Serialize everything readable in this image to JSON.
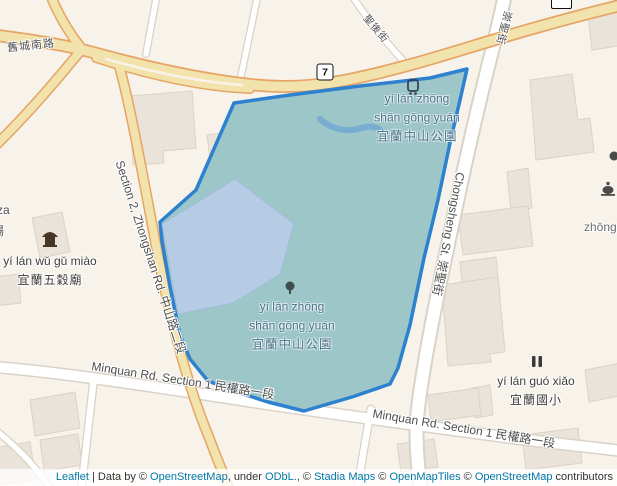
{
  "window": {
    "width": 617,
    "height": 486
  },
  "colors": {
    "land": "#f8f3ea",
    "building": "#eae3d9",
    "building_outline": "#dcd2c5",
    "major_road_fill": "#f2e2ab",
    "major_road_casing": "#e5a566",
    "minor_road_fill": "#ffffff",
    "minor_road_casing": "#d9d2c7",
    "park_overlay_fill": "#9dc6c9",
    "park_overlay_stroke": "#2d81cf",
    "inner_ground_fill": "#b5cce4",
    "water": "#78acd1",
    "road_label": "#4f4f4f",
    "park_label": "#49708a",
    "poi_label": "#3d3d3d",
    "link": "#0078a8"
  },
  "roads": {
    "jiucheng_south_rd": "舊城南路",
    "route_7": "7",
    "shenghou_st": "聖後街",
    "chongsheng_st_short": "崇聖街",
    "chongsheng_st": "Chongsheng St. 崇聖街",
    "zhongshan_rd": "Section 2, Zhongshan Rd. 中山路二段",
    "minquan_rd_west": "Minquan Rd. Section 1 民權路一段",
    "minquan_rd_east": "Minquan Rd. Section 1 民權路一段"
  },
  "places": {
    "park_label_north": {
      "pinyin1": "yí lán zhōng",
      "pinyin2": "shān gōng yuán",
      "hanzi": "宜蘭中山公園"
    },
    "park_label_center": {
      "pinyin1": "yí lán zhōng",
      "pinyin2": "shān gōng yuán",
      "hanzi": "宜蘭中山公園"
    },
    "temple": {
      "pinyin": "yí lán wǔ gǔ miào",
      "hanzi": "宜蘭五穀廟"
    },
    "school": {
      "pinyin": "yí lán guó xiǎo",
      "hanzi": "宜蘭國小"
    },
    "partial_zhong": "zhōng",
    "partial_za": "za",
    "partial_chang": "場"
  },
  "attribution": {
    "leaflet": "Leaflet",
    "sep": " | ",
    "data_by": "Data by © ",
    "osm1": "OpenStreetMap",
    "under": ", under ",
    "odbl": "ODbL.",
    "c1": ", © ",
    "stadia": "Stadia Maps",
    "c2": " © ",
    "openmaptiles": "OpenMapTiles",
    "c3": " © ",
    "osm2": "OpenStreetMap",
    "contributors": " contributors"
  }
}
